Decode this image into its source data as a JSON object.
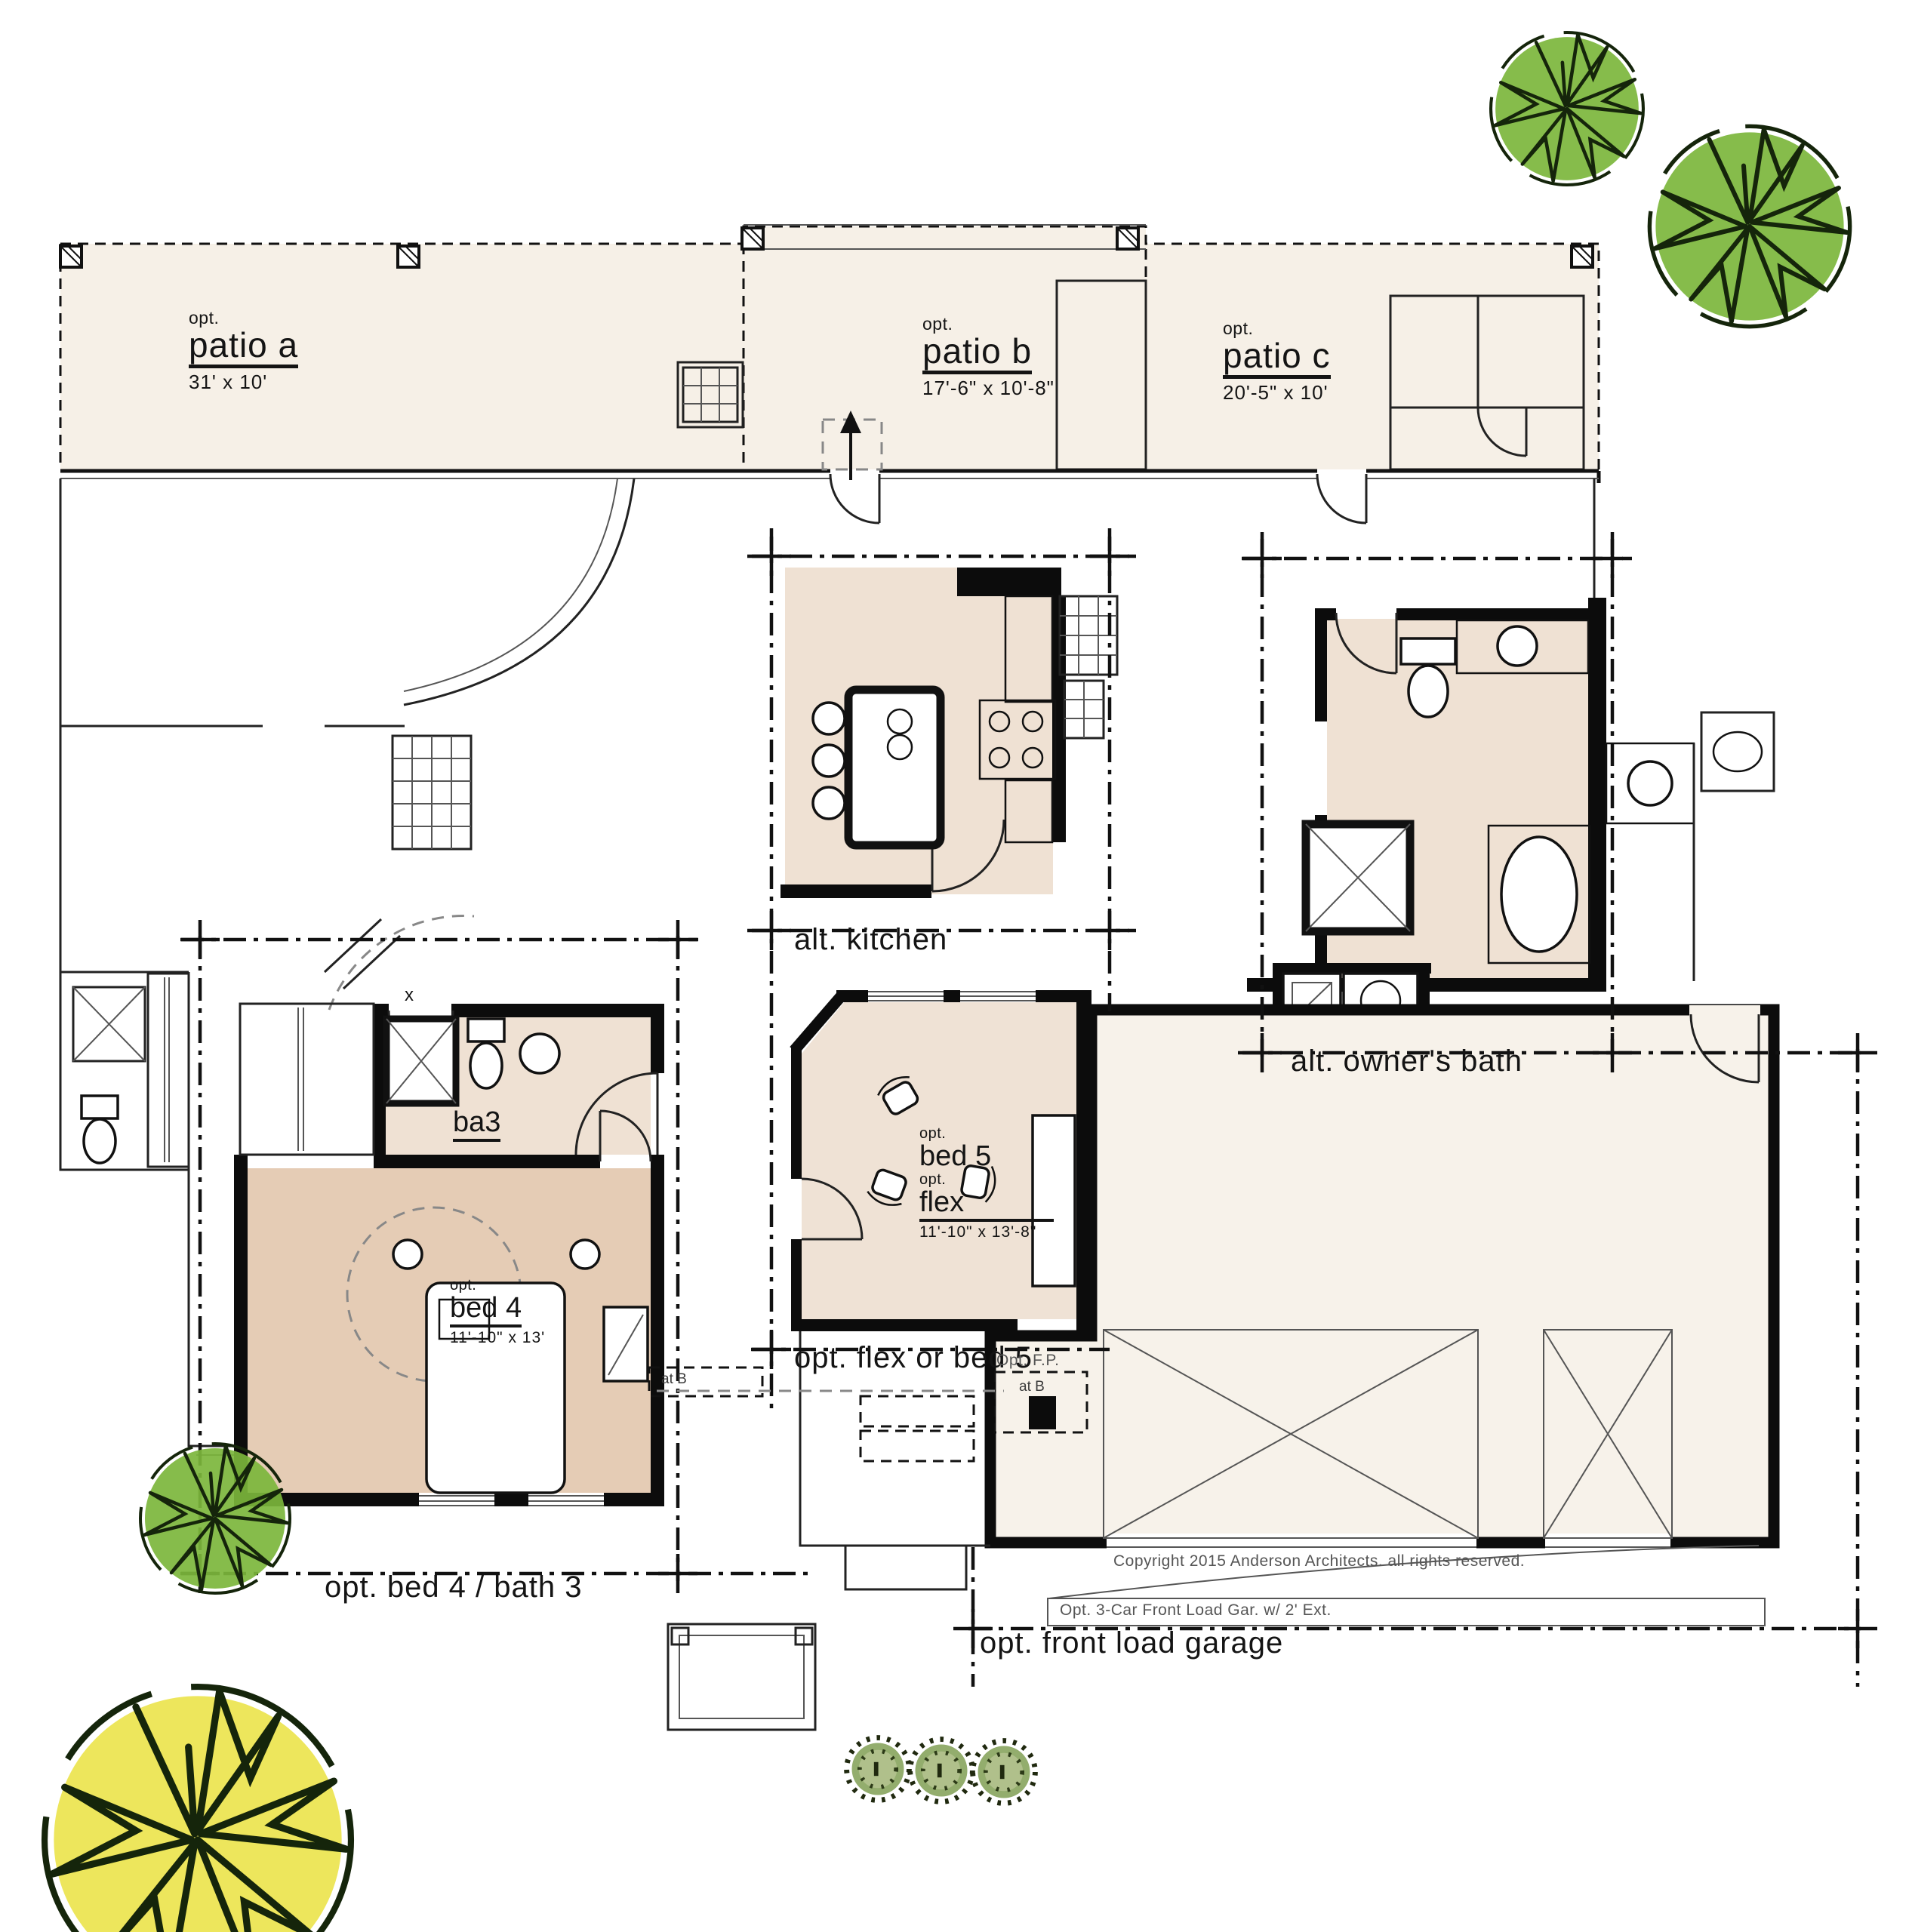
{
  "document": {
    "type": "architectural floor plan options sheet",
    "copyright": "Copyright 2015 Anderson Architects. all rights reserved."
  },
  "patios": [
    {
      "opt": "opt.",
      "name": "patio a",
      "dims": "31' x 10'"
    },
    {
      "opt": "opt.",
      "name": "patio b",
      "dims": "17'-6\" x 10'-8\""
    },
    {
      "opt": "opt.",
      "name": "patio c",
      "dims": "20'-5\" x 10'"
    }
  ],
  "rooms": {
    "alt_kitchen": "alt. kitchen",
    "alt_owners_bath": "alt. owner's bath",
    "ba3": "ba3",
    "bed4": {
      "opt": "opt.",
      "name": "bed 4",
      "dims": "11'-10\" x 13'"
    },
    "bed5_flex": {
      "opt1": "opt.",
      "name1": "bed 5",
      "opt2": "opt.",
      "name2": "flex",
      "dims": "11'-10\" x 13'-8\""
    }
  },
  "option_callouts": {
    "flex_or_bed5": "opt. flex or bed 5",
    "bed4_bath3": "opt. bed 4 / bath 3",
    "front_load_garage": "opt. front load garage",
    "garage_ext_note": "Opt. 3-Car Front Load Gar. w/ 2' Ext.",
    "opt_fp": "Opt. F.P.",
    "at_b_fireplace": "at B",
    "at_b_hall": "at B",
    "x_marker": "x"
  },
  "colors": {
    "paper": "#ffffff",
    "patio_fill": "#f6f0e7",
    "room_fill_light": "#efe1d3",
    "room_fill_tan": "#e5ccb5",
    "flex_fill": "#efe2d5",
    "garage_fill": "#f7f2ea",
    "tree_green": "#7cb63c",
    "tree_yellow": "#ece44e",
    "bush_green": "#93ad6d",
    "line_black": "#111111",
    "note_gray": "#555555"
  }
}
